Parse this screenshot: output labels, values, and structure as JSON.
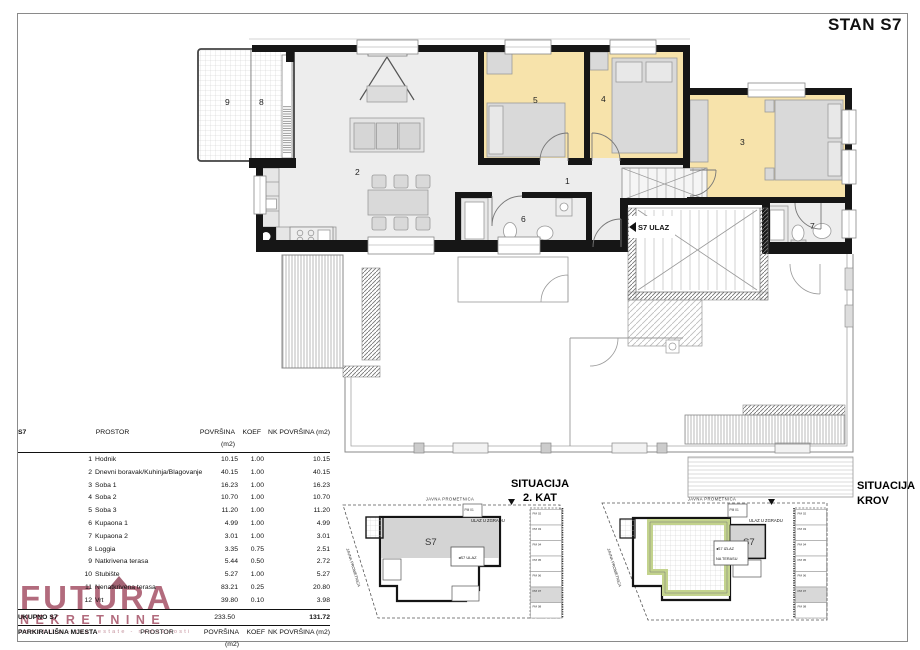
{
  "page": {
    "title": "STAN S7"
  },
  "colors": {
    "wall": "#161616",
    "floor": "#ededed",
    "bedroom_fill": "#f7e3ab",
    "furniture": "#d9d9d9",
    "logo_accent": "#9d4259",
    "roof_terrace_green": "#c3d38d",
    "parking_highlight": "#d8d8d8"
  },
  "plan": {
    "rooms": {
      "r1": "1",
      "r2": "2",
      "r3": "3",
      "r4": "4",
      "r5": "5",
      "r6": "6",
      "r7": "7",
      "r8": "8",
      "r9": "9"
    },
    "entrance_label": "S7 ULAZ"
  },
  "table": {
    "unit": "S7",
    "headers": {
      "prostor": "PROSTOR",
      "povrsina": "POVRŠINA (m2)",
      "koef": "KOEF",
      "nk": "NK POVRŠINA (m2)"
    },
    "rows": [
      {
        "num": "1",
        "name": "Hodnik",
        "povrsina": "10.15",
        "koef": "1.00",
        "nk": "10.15"
      },
      {
        "num": "2",
        "name": "Dnevni boravak/Kuhinja/Blagovanje",
        "povrsina": "40.15",
        "koef": "1.00",
        "nk": "40.15"
      },
      {
        "num": "3",
        "name": "Soba 1",
        "povrsina": "16.23",
        "koef": "1.00",
        "nk": "16.23"
      },
      {
        "num": "4",
        "name": "Soba 2",
        "povrsina": "10.70",
        "koef": "1.00",
        "nk": "10.70"
      },
      {
        "num": "5",
        "name": "Soba 3",
        "povrsina": "11.20",
        "koef": "1.00",
        "nk": "11.20"
      },
      {
        "num": "6",
        "name": "Kupaona 1",
        "povrsina": "4.99",
        "koef": "1.00",
        "nk": "4.99"
      },
      {
        "num": "7",
        "name": "Kupaona 2",
        "povrsina": "3.01",
        "koef": "1.00",
        "nk": "3.01"
      },
      {
        "num": "8",
        "name": "Loggia",
        "povrsina": "3.35",
        "koef": "0.75",
        "nk": "2.51"
      },
      {
        "num": "9",
        "name": "Natkrivena terasa",
        "povrsina": "5.44",
        "koef": "0.50",
        "nk": "2.72"
      },
      {
        "num": "10",
        "name": "Stubište",
        "povrsina": "5.27",
        "koef": "1.00",
        "nk": "5.27"
      },
      {
        "num": "11",
        "name": "Nenatkrivena terasa",
        "povrsina": "83.21",
        "koef": "0.25",
        "nk": "20.80"
      },
      {
        "num": "12",
        "name": "Vrt",
        "povrsina": "39.80",
        "koef": "0.10",
        "nk": "3.98"
      }
    ],
    "total": {
      "label": "UKUPNO S7",
      "povrsina": "233.50",
      "nk": "131.72"
    },
    "parking": {
      "label": "PARKIRALIŠNA MJESTA",
      "row": {
        "name": "PM07",
        "povrsina": "12,60",
        "koef": "0,25",
        "nk": "3,15"
      }
    }
  },
  "situations": {
    "left": {
      "title1": "SITUACIJA",
      "title2": "2. KAT",
      "road_top": "JAVNA PROMETNICA",
      "road_side": "JAVNA PROMETNICA",
      "building_label": "S7",
      "entrance_note": "ULAZ U ZGRADU",
      "unit_entrance": "◂S7 ULAZ",
      "pm01": "PM 01",
      "parking": [
        "PM 02",
        "PM 03",
        "PM 04",
        "PM 05",
        "PM 06",
        "PM 07",
        "PM 08"
      ]
    },
    "right": {
      "title1": "SITUACIJA",
      "title2": "KROV",
      "road_top": "JAVNA PROMETNICA",
      "road_side": "JAVNA PROMETNICA",
      "building_label": "S7",
      "entrance_note": "ULAZ U ZGRADU",
      "exit_line1": "◂S7 IZLAZ",
      "exit_line2": "NA TERASU",
      "pm01": "PM 01",
      "parking": [
        "PM 02",
        "PM 03",
        "PM 04",
        "PM 05",
        "PM 06",
        "PM 07",
        "PM 08"
      ]
    }
  },
  "logo": {
    "line1": "FUTURA",
    "line2": "NEKRETNINE",
    "tagline": "immobilia - real estate - nemovitosti"
  }
}
